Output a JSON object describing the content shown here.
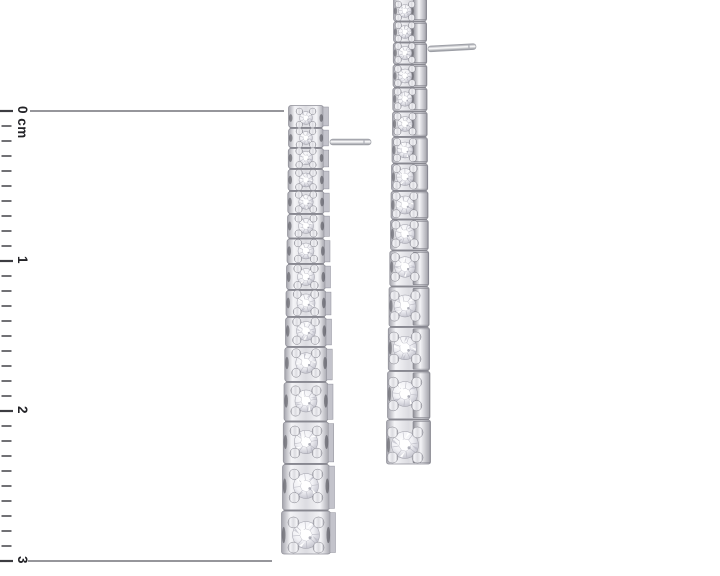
{
  "scene": {
    "background": "#ffffff",
    "alt": "Pair of graduated diamond line drop earrings photographed beside a centimeter scale",
    "indicated_drop_length_cm": 3
  },
  "ruler": {
    "unit": "cm",
    "labels": [
      {
        "text": "0 cm",
        "cm": 0
      },
      {
        "text": "1",
        "cm": 1
      },
      {
        "text": "2",
        "cm": 2
      },
      {
        "text": "3",
        "cm": 3
      }
    ],
    "zero_y": 111,
    "px_per_cm": 150,
    "cm_span": 3,
    "minor_ticks_per_cm": 10,
    "major_tick_len": 13,
    "minor_tick_len": 10,
    "tick_color": "#3c3c41",
    "label_color": "#222226"
  },
  "guides": {
    "color": "#73737a",
    "top": {
      "y": 111,
      "x1": 30,
      "x2": 284
    },
    "bottom": {
      "y": 561,
      "x1": 28,
      "x2": 272
    }
  },
  "materials": {
    "metal_light": "#f4f4f7",
    "metal_mid": "#dcdce1",
    "metal_dark": "#a4a4ac",
    "metal_edge": "#8e8e96",
    "crevice": "#4e4e56",
    "diamond_core": "#ffffff",
    "diamond_facet": "#c9c9d2"
  },
  "earrings": {
    "left": {
      "view": "front",
      "cx": 306,
      "top": 105,
      "post": {
        "x1": 330,
        "x2": 371,
        "y": 142,
        "angle": 0
      },
      "stones": [
        [
          13,
          13
        ],
        [
          33,
          13
        ],
        [
          53,
          13.5
        ],
        [
          75,
          14
        ],
        [
          97,
          14.5
        ],
        [
          121,
          15
        ],
        [
          146,
          16
        ],
        [
          172,
          17
        ],
        [
          198,
          18
        ],
        [
          226,
          19
        ],
        [
          258,
          20.5
        ],
        [
          296,
          22
        ],
        [
          337,
          23.5
        ],
        [
          381,
          25
        ],
        [
          430,
          27
        ]
      ]
    },
    "right": {
      "view": "side",
      "cx": 410,
      "top": 2,
      "post": {
        "x1": 428,
        "x2": 476,
        "y": 49,
        "angle": -3
      },
      "stones": [
        [
          9,
          13
        ],
        [
          30,
          13
        ],
        [
          51,
          13.5
        ],
        [
          74,
          14
        ],
        [
          97,
          14.5
        ],
        [
          122,
          15
        ],
        [
          148,
          16
        ],
        [
          175,
          17
        ],
        [
          203,
          18
        ],
        [
          232,
          19
        ],
        [
          265,
          20.5
        ],
        [
          304,
          22
        ],
        [
          346,
          23.5
        ],
        [
          392,
          25
        ],
        [
          443,
          27
        ]
      ]
    }
  }
}
